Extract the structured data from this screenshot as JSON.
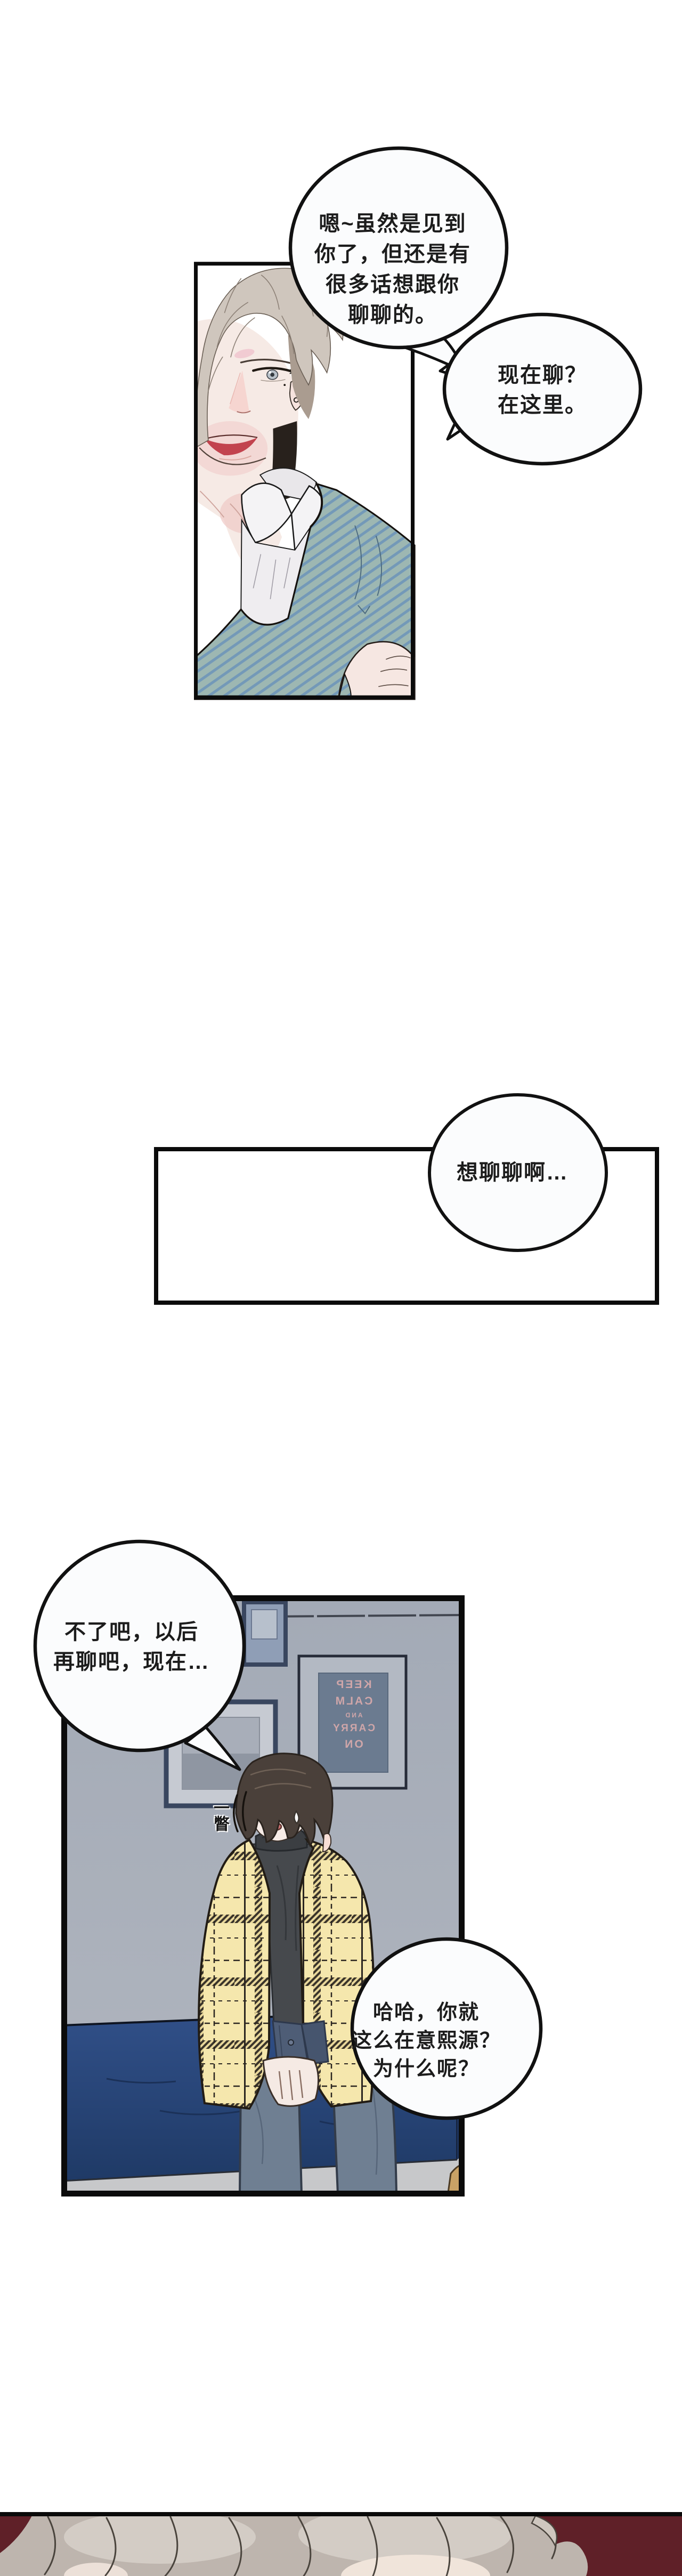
{
  "bubbles": {
    "b1": {
      "text": "嗯~虽然是见到\n你了，但还是有\n很多话想跟你\n聊聊的。"
    },
    "b2": {
      "text": "现在聊？\n在这里。"
    },
    "b3": {
      "text": "不了吧，以后\n再聊吧，现在…"
    },
    "b4": {
      "text": "哈哈，你就\n这么在意熙源？\n为什么呢？"
    },
    "b5": {
      "text": "想聊聊啊…"
    }
  },
  "sfx": {
    "glance": "一瞥"
  },
  "poster": {
    "lines": [
      "KEEP",
      "CALM",
      "AND",
      "CARRY",
      "ON"
    ]
  },
  "colors": {
    "page_bg": "#ffffff",
    "panel_border": "#0b0b0b",
    "bubble_fill": "#fbfcfd",
    "bubble_border": "#111111",
    "sweater_teal": "#9db7b2",
    "sweater_stripe": "#6f96ba",
    "skin": "#f6eae5",
    "lips_red": "#c2434e",
    "hair_blond": "#cfc6bd",
    "wall_grey": "#acb2bd",
    "bench_navy": "#2d4d80",
    "floor_grey": "#c7c8ca",
    "poster_bg": "#6b7b90",
    "poster_text": "#cfa6a9",
    "frame_navy": "#39465f",
    "cardigan_yellow": "#f5e7ad",
    "turtleneck_grey": "#46494d",
    "jeans_blue": "#6f7f92",
    "boy_hair_dark": "#4a403a",
    "maroon_bg": "#5f2028",
    "back_hair_beige": "#beb5ae"
  }
}
